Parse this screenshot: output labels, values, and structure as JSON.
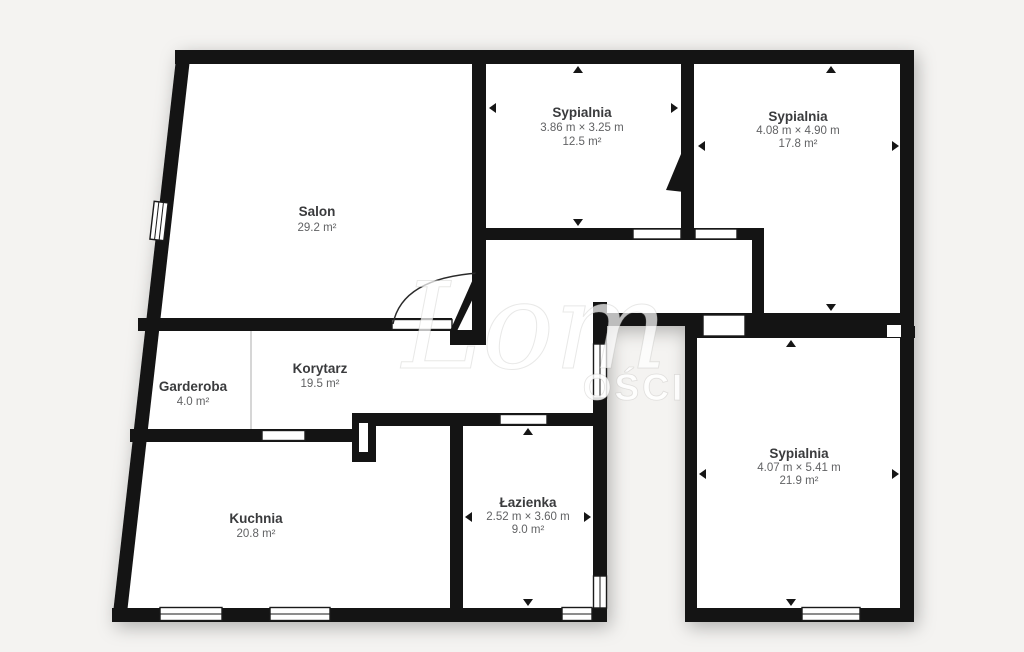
{
  "plan": {
    "background_color": "#f4f3f1",
    "wall_color": "#141414",
    "rooms": [
      {
        "id": "salon",
        "name": "Salon",
        "dims": "",
        "area": "29.2 m²"
      },
      {
        "id": "sypialnia-1",
        "name": "Sypialnia",
        "dims": "3.86 m × 3.25 m",
        "area": "12.5 m²"
      },
      {
        "id": "sypialnia-2",
        "name": "Sypialnia",
        "dims": "4.08 m × 4.90 m",
        "area": "17.8 m²"
      },
      {
        "id": "garderoba",
        "name": "Garderoba",
        "dims": "",
        "area": "4.0 m²"
      },
      {
        "id": "korytarz",
        "name": "Korytarz",
        "dims": "",
        "area": "19.5 m²"
      },
      {
        "id": "kuchnia",
        "name": "Kuchnia",
        "dims": "",
        "area": "20.8 m²"
      },
      {
        "id": "lazienka",
        "name": "Łazienka",
        "dims": "2.52 m × 3.60 m",
        "area": "9.0 m²"
      },
      {
        "id": "sypialnia-3",
        "name": "Sypialnia",
        "dims": "4.07 m × 5.41 m",
        "area": "21.9 m²"
      }
    ],
    "watermark": {
      "script_text": "Lom",
      "caps_text": "OŚCI"
    }
  }
}
